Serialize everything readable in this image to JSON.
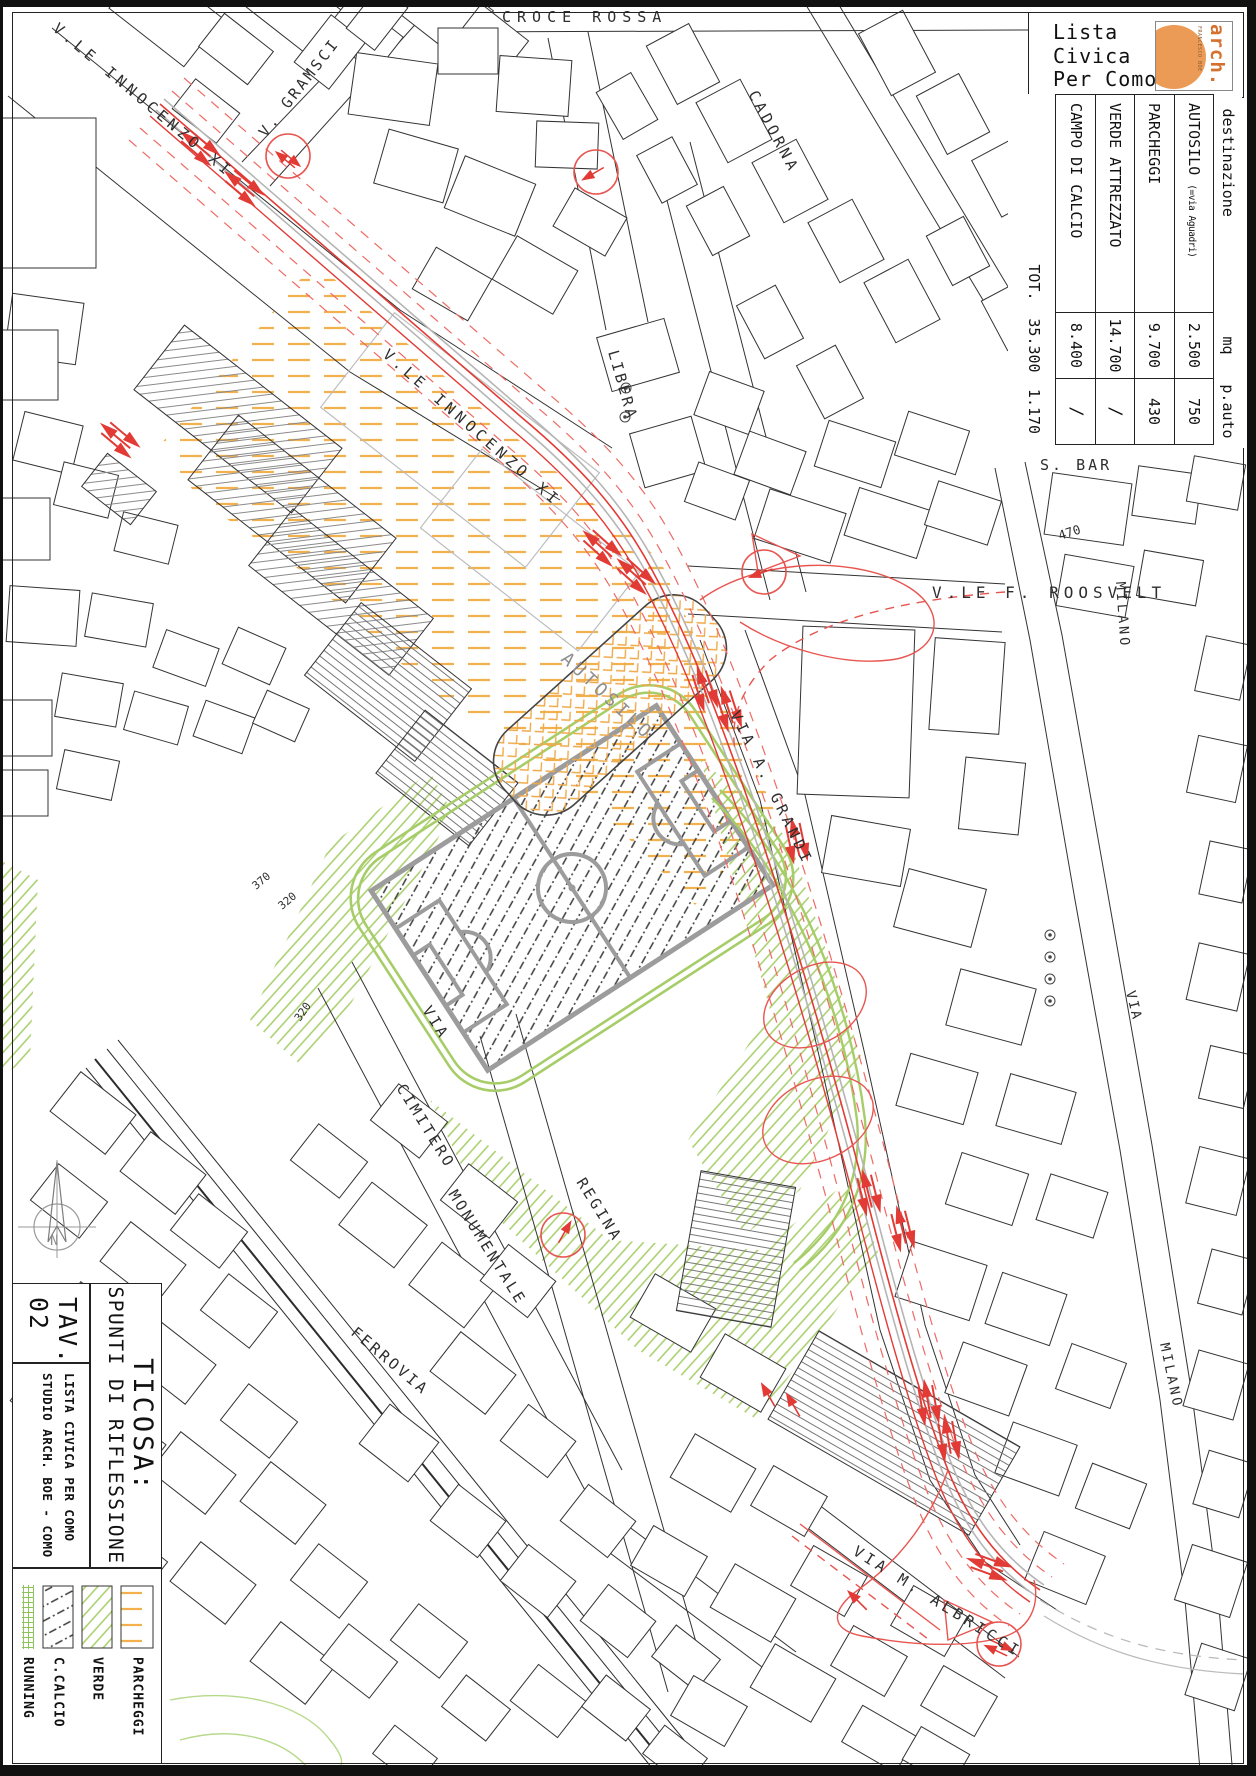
{
  "header_block": {
    "org_line1": "Lista",
    "org_line2": "Civica",
    "org_line3": "Per Como",
    "logo_text": "arch.",
    "logo_subtext": "FRANCESCO BOE"
  },
  "program_table": {
    "headers": {
      "destinazione": "destinazione",
      "mq": "mq",
      "pauto": "p.auto"
    },
    "rows": [
      {
        "name": "AUTOSILO",
        "note": "(=via Aguadri)",
        "mq": "2.500",
        "pauto": "750"
      },
      {
        "name": "PARCHEGGI",
        "note": "",
        "mq": "9.700",
        "pauto": "430"
      },
      {
        "name": "VERDE ATTREZZATO",
        "note": "",
        "mq": "14.700",
        "pauto": "/"
      },
      {
        "name": "CAMPO DI CALCIO",
        "note": "",
        "mq": "8.400",
        "pauto": "/"
      }
    ],
    "total": {
      "label": "TOT.",
      "mq": "35.300",
      "pauto": "1.170"
    }
  },
  "title_block": {
    "tav_label": "TAV.",
    "tav_number": "02",
    "title": "TICOSA:",
    "subtitle": "SPUNTI DI RIFLESSIONE",
    "credit1": "LISTA CIVICA PER COMO",
    "credit2": "STUDIO ARCH. BOE - COMO"
  },
  "legend": {
    "items": [
      {
        "label": "RUNNING"
      },
      {
        "label": "C.CALCIO"
      },
      {
        "label": "VERDE"
      },
      {
        "label": "PARCHEGGI"
      }
    ]
  },
  "map_labels": {
    "croce_rossa": "CROCE ROSSA",
    "gramsci": "V. GRAMSCI",
    "innocenzo_a": "V.LE INNOCENZO XI",
    "innocenzo_b": "V.LE INNOCENZO XI",
    "cadorna": "CADORNA",
    "libera": "LIBERA",
    "roosvelt": "V.LE F. ROOSVELT",
    "milano_a": "MILANO",
    "milano_b": "MILANO",
    "s_bar": "S. BAR",
    "elev_470": "470",
    "grandi": "VIA A. GRANDI",
    "autosilo": "AUTOSILO",
    "via_small": "VIA",
    "via_cim": "VIA",
    "cimitero": "CIMITERO",
    "monumentale": "MONUMENTALE",
    "regina": "REGINA",
    "ferrovia": "FERROVIA",
    "albricci": "VIA  M.  ALBRICCI",
    "elev_370": "370",
    "elev_320": "320",
    "elev_320b": "320",
    "north": "N"
  },
  "colors": {
    "scheme_red": "#e23b36",
    "scheme_red_light": "#ef6a64",
    "parking_orange": "#f2b14e",
    "green": "#a6cd68",
    "field_gray": "#9c9c9c"
  }
}
